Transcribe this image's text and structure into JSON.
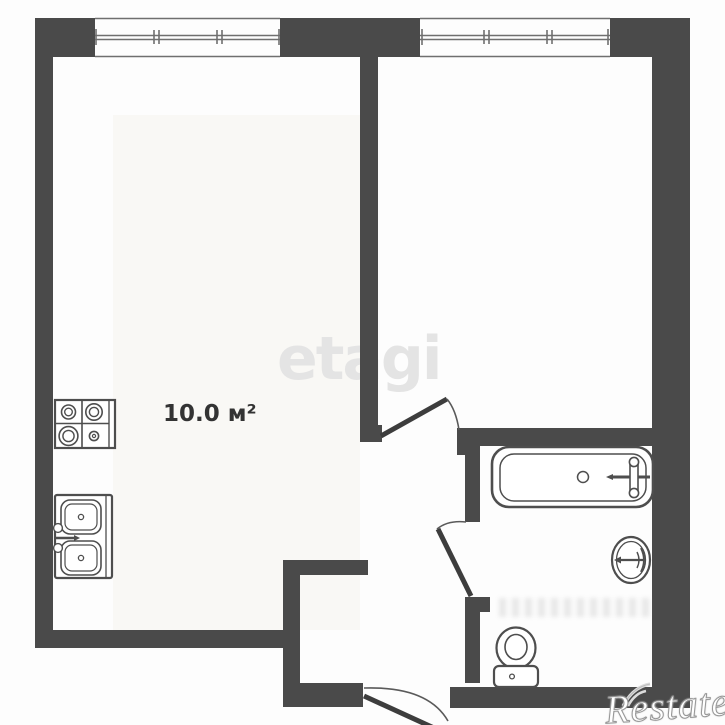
{
  "title": "One-room apartment floor plan",
  "colors": {
    "wall": "#4a4a4a",
    "fixture_line": "#4e4e4e",
    "window_line": "#6f6f6f",
    "door_line": "#3d3d3d",
    "label_text": "#333333",
    "watermark_center": "#e4e4e4",
    "watermark_corner_fill": "#ffffff",
    "watermark_corner_outline": "#969696",
    "background": "#fdfdfd"
  },
  "rooms": [
    {
      "name": "kitchen-living-room",
      "area_label": "10.0 м²"
    },
    {
      "name": "bedroom",
      "area_label": ""
    },
    {
      "name": "bathroom",
      "area_label": ""
    },
    {
      "name": "entrance-hallway",
      "area_label": ""
    }
  ],
  "fixtures": [
    "stove-4-burner",
    "kitchen-double-sink",
    "bathtub",
    "wash-basin",
    "toilet"
  ],
  "windows": [
    "window-left",
    "window-right"
  ],
  "doors": [
    "bedroom-door",
    "bathroom-door",
    "entrance-door"
  ],
  "watermarks": {
    "center": "etagi",
    "corner": "Restate"
  }
}
